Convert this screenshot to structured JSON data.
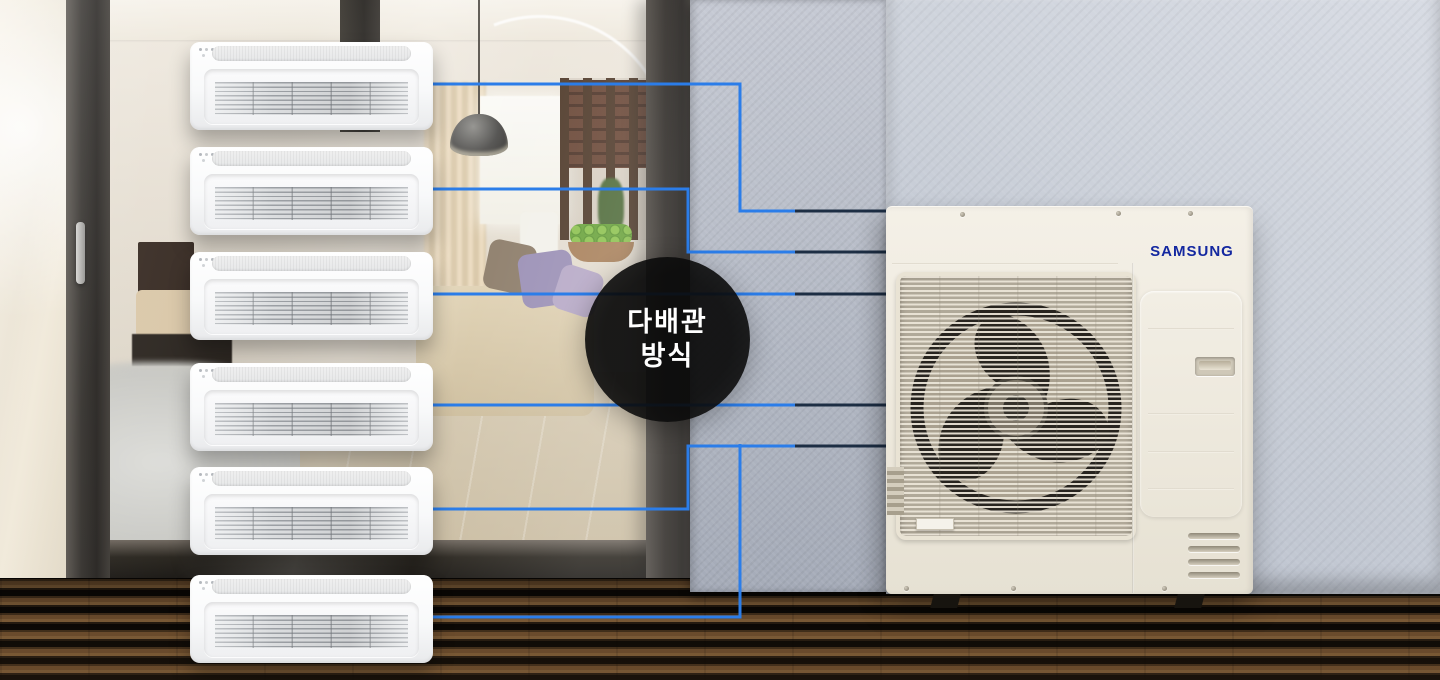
{
  "badge": {
    "line1": "다배관",
    "line2": "방식"
  },
  "outdoor_unit": {
    "brand_logo": "SAMSUNG"
  },
  "diagram": {
    "indoor_unit_count": 6,
    "pipe_stroke_width": 3,
    "pipe_color_blue": "#2b7de9",
    "pipe_color_dark": "#1d2e44",
    "blue_routes": [
      [
        [
          430,
          84
        ],
        [
          740,
          84
        ],
        [
          740,
          211
        ],
        [
          798,
          211
        ]
      ],
      [
        [
          430,
          189
        ],
        [
          688,
          189
        ],
        [
          688,
          252
        ],
        [
          798,
          252
        ]
      ],
      [
        [
          430,
          294
        ],
        [
          798,
          294
        ]
      ],
      [
        [
          430,
          405
        ],
        [
          798,
          405
        ]
      ],
      [
        [
          430,
          509
        ],
        [
          688,
          509
        ],
        [
          688,
          446
        ],
        [
          798,
          446
        ]
      ],
      [
        [
          430,
          617
        ],
        [
          740,
          617
        ],
        [
          740,
          444
        ]
      ]
    ],
    "dark_routes": [
      [
        [
          795,
          211
        ],
        [
          886,
          211
        ]
      ],
      [
        [
          795,
          252
        ],
        [
          886,
          252
        ]
      ],
      [
        [
          795,
          294
        ],
        [
          886,
          294
        ]
      ],
      [
        [
          795,
          405
        ],
        [
          886,
          405
        ]
      ],
      [
        [
          795,
          446
        ],
        [
          886,
          446
        ]
      ]
    ]
  },
  "colors": {
    "samsung_blue": "#1428a0",
    "badge_background": "rgba(12,12,12,0.88)"
  }
}
